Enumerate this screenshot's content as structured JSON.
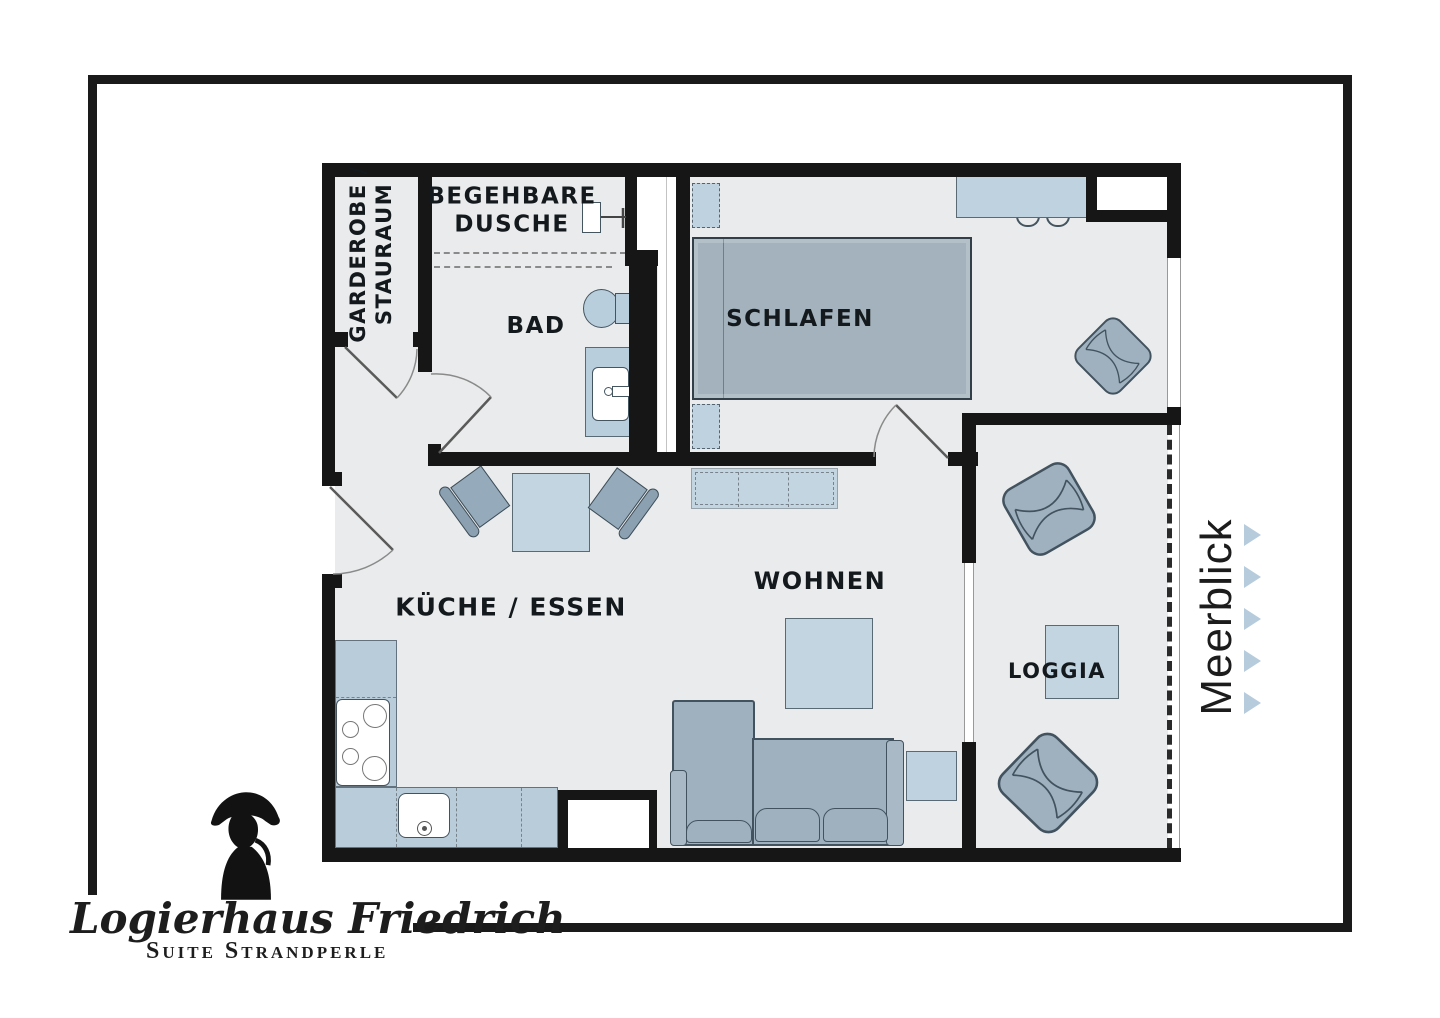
{
  "rooms": {
    "garderobe": {
      "line1": "GARDEROBE /",
      "line2": "STAURAUM"
    },
    "dusche": {
      "line1": "BEGEHBARE",
      "line2": "DUSCHE"
    },
    "bad": {
      "label": "BAD"
    },
    "schlafen": {
      "label": "SCHLAFEN"
    },
    "kueche": {
      "label": "KÜCHE / ESSEN"
    },
    "wohnen": {
      "label": "WOHNEN"
    },
    "loggia": {
      "label": "LOGGIA"
    }
  },
  "view": {
    "label": "Meerblick",
    "arrows": 5,
    "arrow_color": "#b6cbdc"
  },
  "logo": {
    "name": "Logierhaus Friedrich",
    "subtitle": "Suite Strandperle"
  },
  "colors": {
    "wall": "#161616",
    "floor": "#e9ebec",
    "furniture_light": "#c4d5e2",
    "furniture_counter": "#b9ccd9",
    "furniture_gray": "#9fb1bf",
    "bed": "#a3b2bc",
    "frame": "#1a1a1a"
  }
}
